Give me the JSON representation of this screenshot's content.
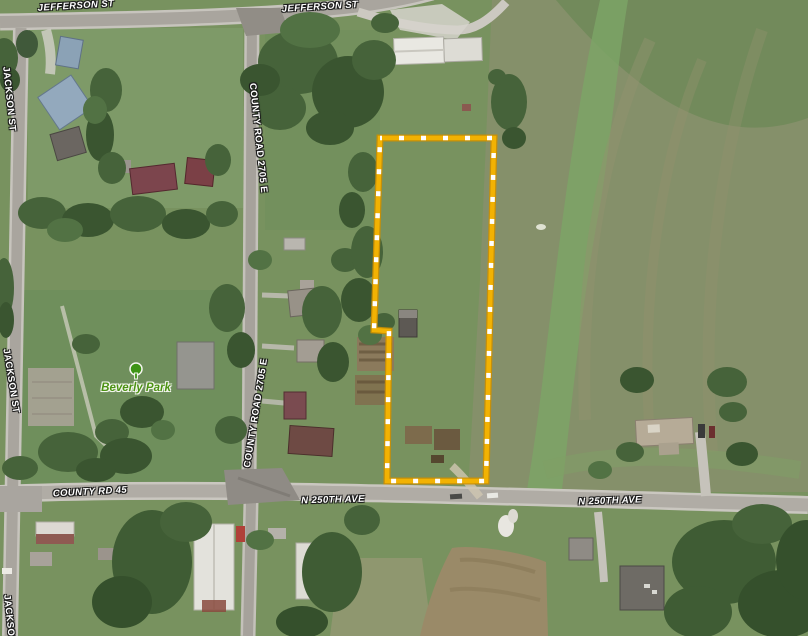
{
  "map": {
    "street_labels": {
      "jefferson_st_left": "JEFFERSON ST",
      "jefferson_st_right": "JEFFERSON ST",
      "jackson_st_top": "JACKSON ST",
      "jackson_st_mid": "JACKSON ST",
      "jackson_st_bottom": "JACKSON ST",
      "county_road_2705e_north": "COUNTY ROAD 2705 E",
      "county_road_2705e_south": "COUNTY ROAD 2705 E",
      "county_rd_45": "COUNTY RD 45",
      "n_250th_ave_west": "N 250TH AVE",
      "n_250th_ave_east": "N 250TH AVE"
    },
    "poi_labels": {
      "beverly_park": "Beverly Park"
    },
    "parcel": {
      "outline_color": "#f2b203",
      "outline_dash_color": "#ffffff",
      "outline_edge_color": "#cd8f00"
    }
  }
}
